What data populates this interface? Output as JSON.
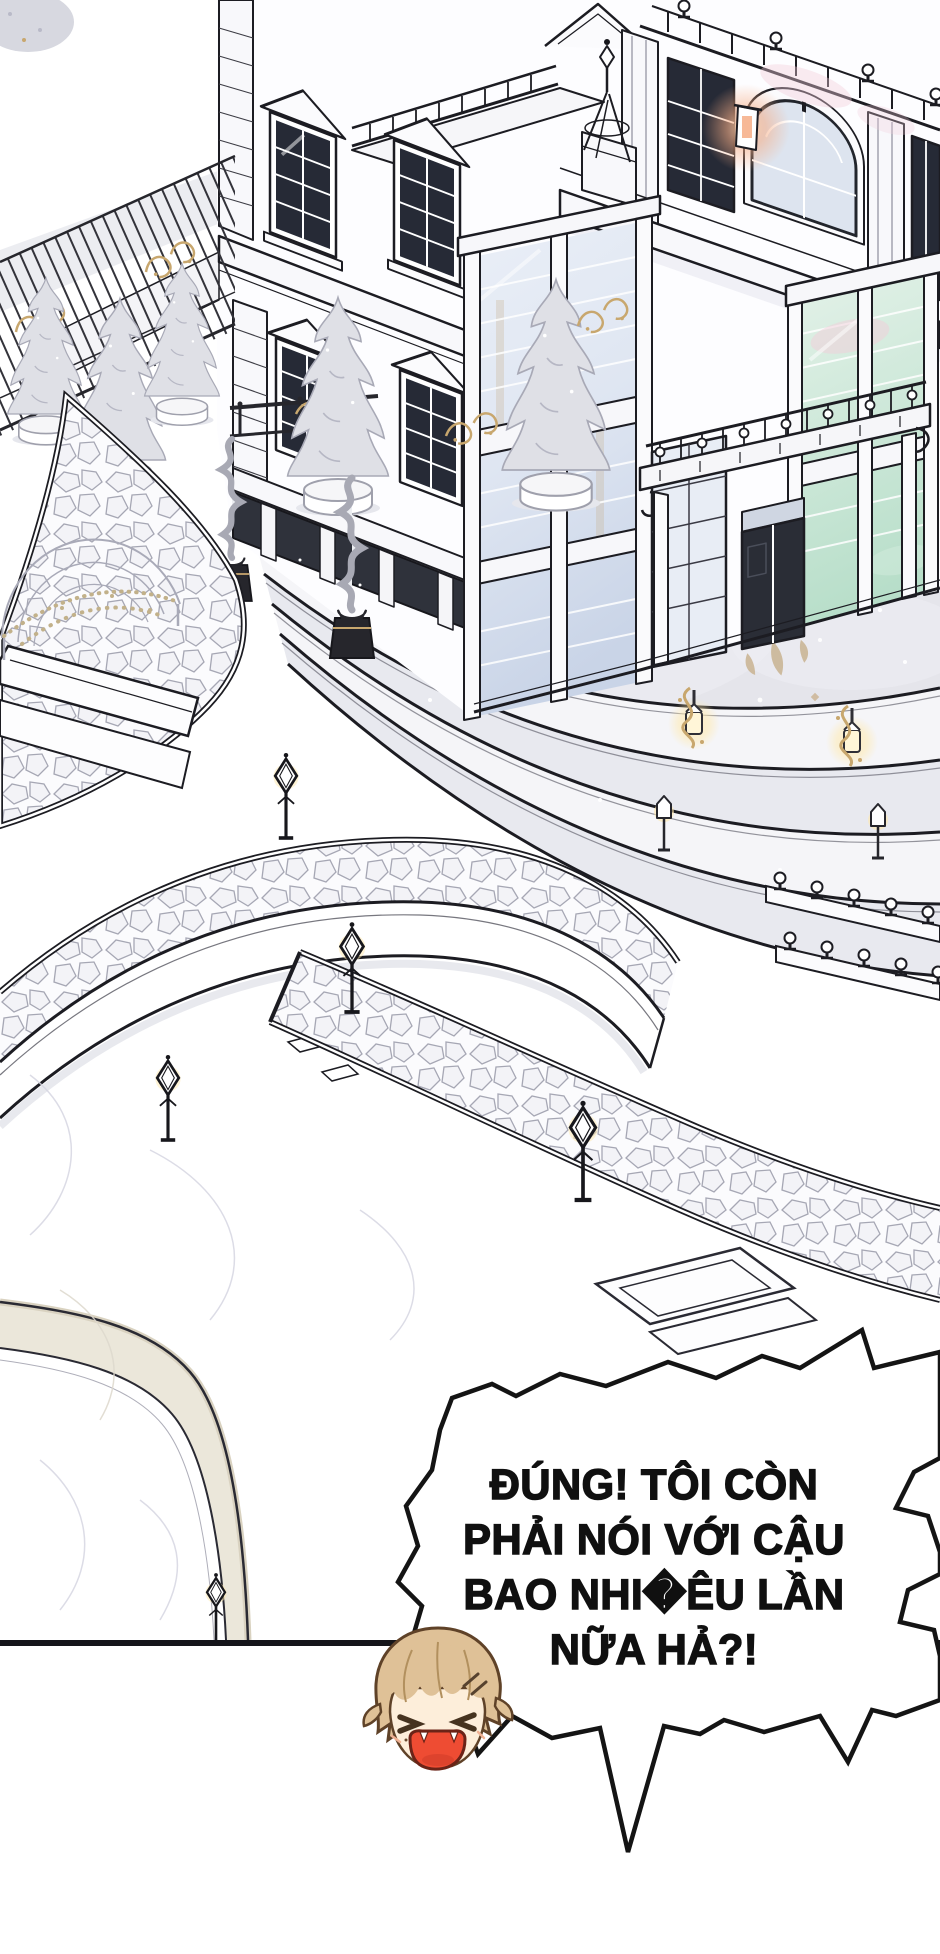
{
  "panel": {
    "kind": "webtoon-comic-panel",
    "background": "#ffffff",
    "ink": "#1c1c22",
    "bottom_border_color": "#15151a"
  },
  "speech_bubble": {
    "lines": [
      "ĐÚNG! TÔI CÒN",
      "PHẢI NÓI VỚI CẬU",
      "BAO NHI�ÊU LẦN",
      "NỮA HẢ?!"
    ],
    "full_text": "ĐÚNG! TÔI CÒN PHẢI NÓI VỚI CẬU BAO NHIÊU LẦN NỮA HẢ?!",
    "fill": "#ffffff",
    "stroke": "#141414",
    "text_color": "#101010"
  },
  "character": {
    "id": "chibi-angry-boy",
    "expression": "angry-shouting",
    "hair_color": "#dfc197",
    "hair_line_color": "#5f4228",
    "skin_color": "#fdeeda",
    "eye_color": "#46331f",
    "mouth_color": "#ee4c33"
  },
  "scene": {
    "elements": [
      "mansion-facade",
      "conservatory-bay-windows",
      "entrance-canopy-with-urn-balustrade",
      "curved-stone-steps",
      "terrace-with-fleur-de-lis-motif",
      "garden-cobblestone-paths",
      "wrought-iron-fence-with-conifers",
      "spiral-topiaries",
      "gazebo-dome",
      "garden-lamp-posts",
      "golden-lanterns",
      "roof-balustrade-with-urns",
      "finial-spire"
    ],
    "palette": {
      "terrace_gray": "#e5e5eb",
      "step_light": "#f5f5f8",
      "step_shade": "#e8e9ef",
      "glass_dark": "#262a36",
      "glass_blue": "#dfe8f3",
      "glass_green": "#cfe9da",
      "glass_pink": "#f2cdd9",
      "foliage_gray": "#dfe0e6",
      "gold": "#c8a76e",
      "tan_motif": "#c9b391",
      "lamp_glow": "#ffe9ad",
      "warm_glow": "#f6ad85"
    }
  }
}
